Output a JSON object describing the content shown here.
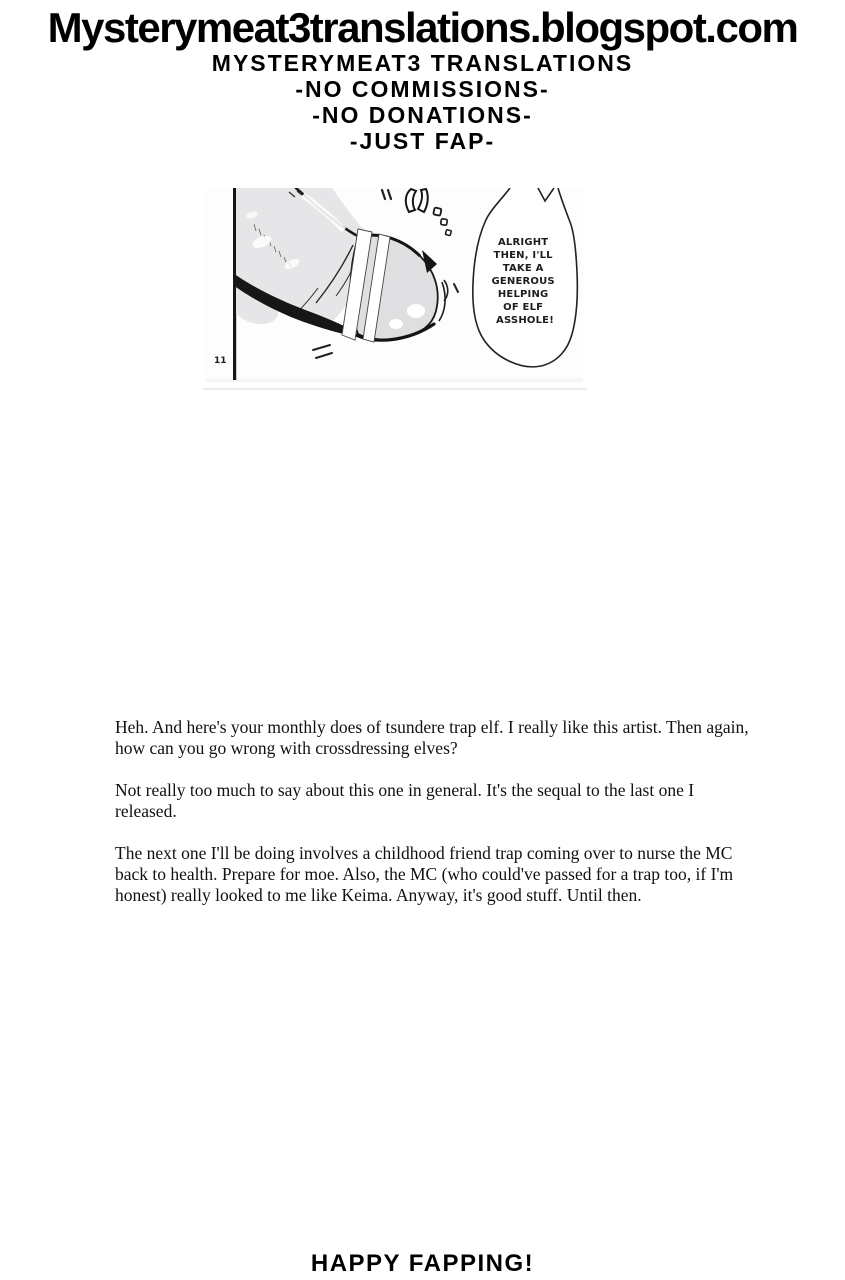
{
  "page": {
    "background": "#ffffff",
    "ink": "#000000"
  },
  "header": {
    "blog_url": "Mysterymeat3translations.blogspot.com",
    "group_name": "MYSTERYMEAT3 TRANSLATIONS",
    "policy_lines": [
      "-NO COMMISSIONS-",
      "-NO DONATIONS-",
      "-JUST FAP-"
    ]
  },
  "manga_panel": {
    "page_number": "11",
    "speech_bubble_lines": [
      "ALRIGHT",
      "THEN, I'LL",
      "TAKE A",
      "GENEROUS",
      "HELPING",
      "OF ELF",
      "ASSHOLE!"
    ],
    "tone_color": "#e6e6e8",
    "cone_tone_color": "#dfdfe1",
    "ink_color": "#1a1a1a"
  },
  "notes": {
    "paragraphs": [
      "Heh. And here's your monthly does of tsundere trap elf. I really like this artist. Then again, how can you go wrong with crossdressing elves?",
      "Not really too much to say about this one in general. It's the sequal to the last one I released.",
      "The next one I'll be doing involves a childhood friend trap coming over to nurse the MC back to health. Prepare for moe. Also, the MC (who could've passed for a trap too, if I'm honest) really looked to me like Keima. Anyway, it's good stuff. Until then."
    ]
  },
  "footer": {
    "message": "HAPPY FAPPING!"
  }
}
